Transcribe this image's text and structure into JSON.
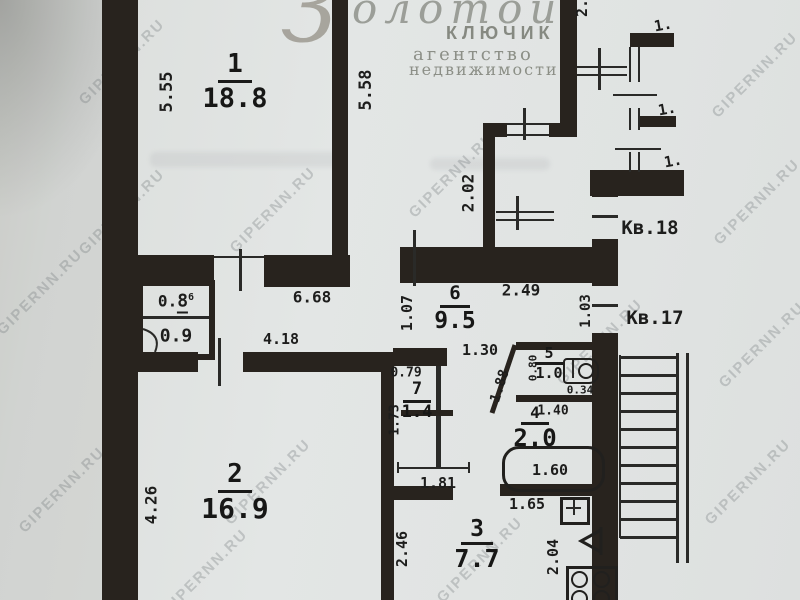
{
  "logo": {
    "script_initial": "З",
    "script_rest": "олотой",
    "line2": "КЛЮЧИК",
    "line3": "агентство",
    "line4": "недвижимости"
  },
  "watermark": {
    "text": "GIPERNN.RU"
  },
  "apartments": {
    "kv18": "Кв.18",
    "kv17": "Кв.17"
  },
  "rooms": {
    "room1": {
      "number": "1",
      "area": "18.8"
    },
    "room2": {
      "number": "2",
      "area": "16.9"
    },
    "room3": {
      "number": "3",
      "area": "7.7"
    },
    "room4": {
      "number": "4",
      "area": "2.0"
    },
    "room5": {
      "number": "5",
      "area": "1.0"
    },
    "room6": {
      "number": "6",
      "area": "9.5"
    },
    "room7": {
      "number": "7",
      "area": "1.4"
    },
    "closet_top": {
      "prefix": "0.",
      "digit": "8",
      "sup": "6"
    },
    "closet_bottom": {
      "area": "0.9"
    }
  },
  "dims": {
    "d555": "5.55",
    "d558": "5.58",
    "d2cut": "2.",
    "d202": "2.02",
    "d1a": "1.",
    "d1b": "1.",
    "d1c": "1.",
    "d668": "6.68",
    "d418": "4.18",
    "d249": "2.49",
    "d107": "1.07",
    "d103": "1.03",
    "d130": "1.30",
    "d079": "0.79",
    "d173": "1.73",
    "d181": "1.81",
    "d188": "1.88",
    "d080": "0.80",
    "d034": "0.34",
    "d140": "1.40",
    "d160": "1.60",
    "d426": "4.26",
    "d246": "2.46",
    "d165": "1.65",
    "d204": "2.04"
  }
}
